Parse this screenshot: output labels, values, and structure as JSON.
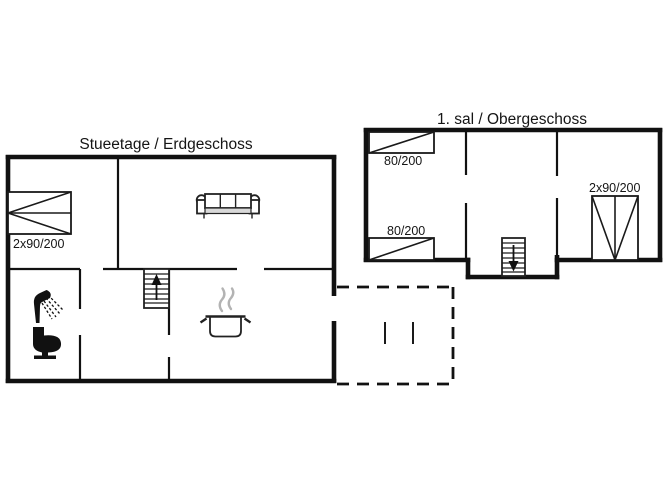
{
  "diagram_type": "house-floor-plan",
  "colors": {
    "background": "#ffffff",
    "line": "#111111",
    "steam": "#b3b3b3",
    "shade": "#d9d9d9"
  },
  "ground_floor": {
    "title": "Stueetage / Erdgeschoss",
    "bed_label": "2x90/200",
    "icons": [
      "double-bed",
      "sofa",
      "stairs-up",
      "cooking-pot",
      "shower",
      "toilet"
    ]
  },
  "upper_floor": {
    "title": "1. sal / Obergeschoss",
    "bed_top_label": "80/200",
    "bed_bottom_label": "80/200",
    "bed_double_label": "2x90/200",
    "icons": [
      "single-bed",
      "single-bed",
      "double-bed",
      "stairs-down"
    ]
  },
  "terrace": {
    "style": "dashed-outline"
  }
}
